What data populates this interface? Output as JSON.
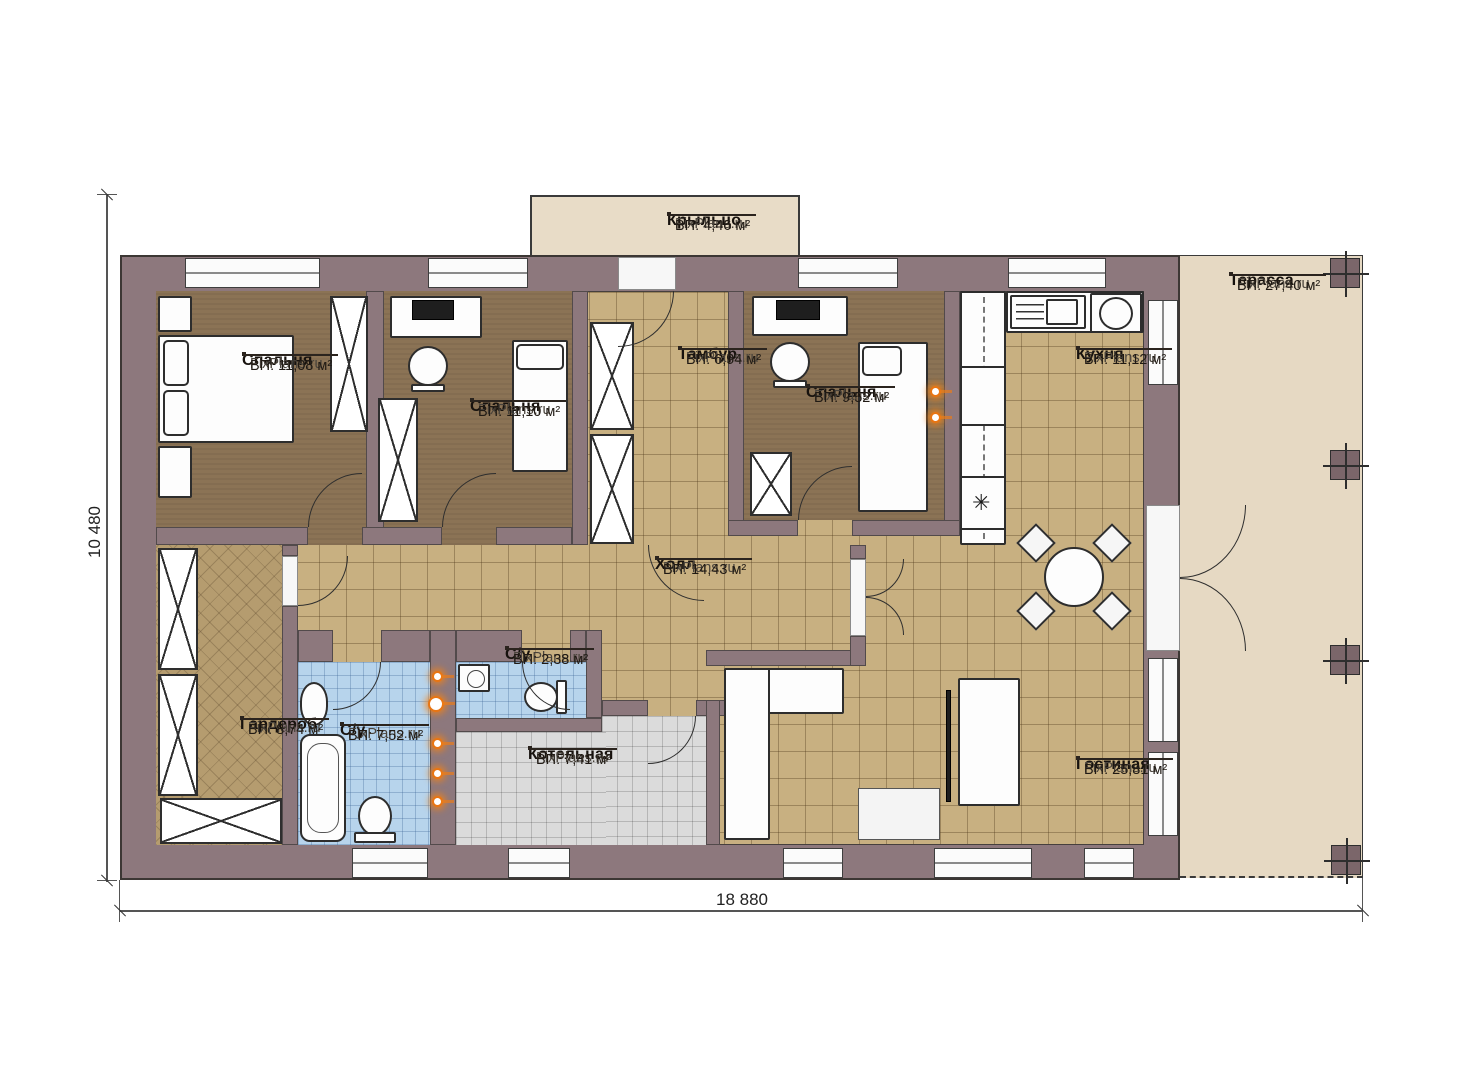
{
  "brand": "FixPlans.ru",
  "icons": {
    "fridge_symbol": "✳"
  },
  "dimensions": {
    "bottom": "18 880",
    "left": "10 480"
  },
  "colors": {
    "wall": "#8d787d",
    "floor_tile": "#c8b081",
    "bedroom_floor": "#8b7355",
    "bath_tile": "#b7d4ec",
    "boiler_tile": "#dbdbdb",
    "terrace": "#e6d9c3",
    "porch": "#e8dcc7",
    "wardrobe_floor": "#b59c6f",
    "riser_accent": "#e87513"
  },
  "rooms": [
    {
      "id": "porch",
      "name": "Крыльцо",
      "area": "ВП: 4,46 м²"
    },
    {
      "id": "bedroom-1",
      "name": "Спальня",
      "area": "ВП: 11,08 м²"
    },
    {
      "id": "bedroom-2",
      "name": "Спальня",
      "area": "ВП: 11,10 м²"
    },
    {
      "id": "vestibule",
      "name": "Тамбур",
      "area": "ВП: 6,94 м²"
    },
    {
      "id": "bedroom-3",
      "name": "Спальня",
      "area": "ВП: 9,52 м²"
    },
    {
      "id": "kitchen",
      "name": "Кухня",
      "area": "ВП: 11,12 м²"
    },
    {
      "id": "terrace",
      "name": "Терасса",
      "area": "ВП: 27,40 м²"
    },
    {
      "id": "hall",
      "name": "Холл",
      "area": "ВП: 14,43 м²"
    },
    {
      "id": "wardrobe",
      "name": "Гардероб",
      "area": "ВП: 8,74 м²"
    },
    {
      "id": "bathroom-1",
      "name": "С/у",
      "area": "ВП: 7,52 м²"
    },
    {
      "id": "bathroom-2",
      "name": "С/у",
      "area": "ВП: 2,38 м²"
    },
    {
      "id": "boiler-room",
      "name": "Котельная",
      "area": "ВП: 7,41 м²"
    },
    {
      "id": "living-room",
      "name": "Гостиная",
      "area": "ВП: 25,81 м²"
    }
  ]
}
